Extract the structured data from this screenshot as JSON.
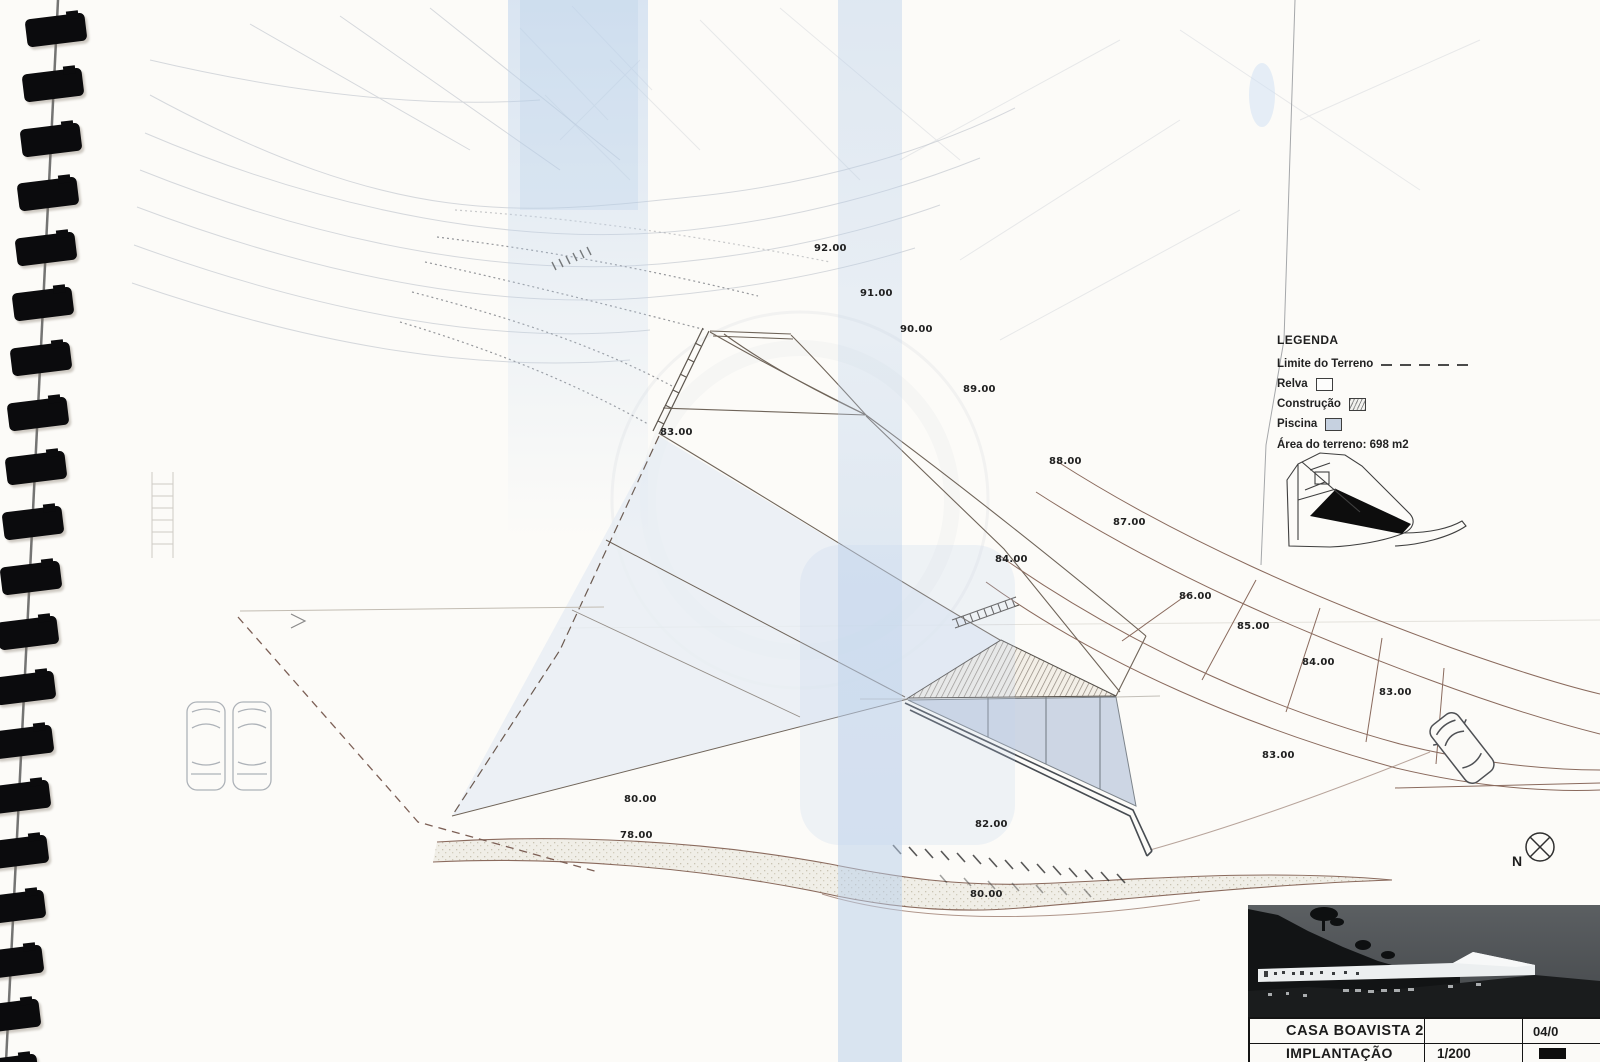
{
  "document": {
    "kind": "scanned architectural site plan, spiral-bound notebook page"
  },
  "legend": {
    "title": "LEGENDA",
    "items": [
      {
        "label": "Limite do Terreno",
        "swatch": "dash"
      },
      {
        "label": "Relva",
        "swatch": "empty"
      },
      {
        "label": "Construção",
        "swatch": "hatch"
      },
      {
        "label": "Piscina",
        "swatch": "pool"
      }
    ],
    "area_note": "Área do terreno: 698 m2"
  },
  "elevation_labels": [
    {
      "text": "92.00",
      "x": 814,
      "y": 243
    },
    {
      "text": "91.00",
      "x": 860,
      "y": 288
    },
    {
      "text": "90.00",
      "x": 900,
      "y": 324
    },
    {
      "text": "89.00",
      "x": 963,
      "y": 384
    },
    {
      "text": "88.00",
      "x": 1049,
      "y": 456
    },
    {
      "text": "87.00",
      "x": 1113,
      "y": 517
    },
    {
      "text": "84.00",
      "x": 995,
      "y": 554
    },
    {
      "text": "86.00",
      "x": 1179,
      "y": 591
    },
    {
      "text": "85.00",
      "x": 1237,
      "y": 621
    },
    {
      "text": "84.00",
      "x": 1302,
      "y": 657
    },
    {
      "text": "83.00",
      "x": 1379,
      "y": 687
    },
    {
      "text": "83.00",
      "x": 660,
      "y": 427
    },
    {
      "text": "83.00",
      "x": 1262,
      "y": 750
    },
    {
      "text": "80.00",
      "x": 624,
      "y": 794
    },
    {
      "text": "78.00",
      "x": 620,
      "y": 830
    },
    {
      "text": "82.00",
      "x": 975,
      "y": 819
    },
    {
      "text": "80.00",
      "x": 970,
      "y": 889
    }
  ],
  "compass": {
    "label": "N"
  },
  "title_block": {
    "project": "CASA BOAVISTA 2",
    "date_fragment": "04/0",
    "drawing": "IMPLANTAÇÃO",
    "scale": "1/200"
  },
  "colors": {
    "paper": "#fcfbf8",
    "boundary_brown": "#8a6a5d",
    "scan_blue": "#c9dcf2",
    "pool_fill": "#c8d3e2",
    "ink": "#1c1c1c"
  }
}
